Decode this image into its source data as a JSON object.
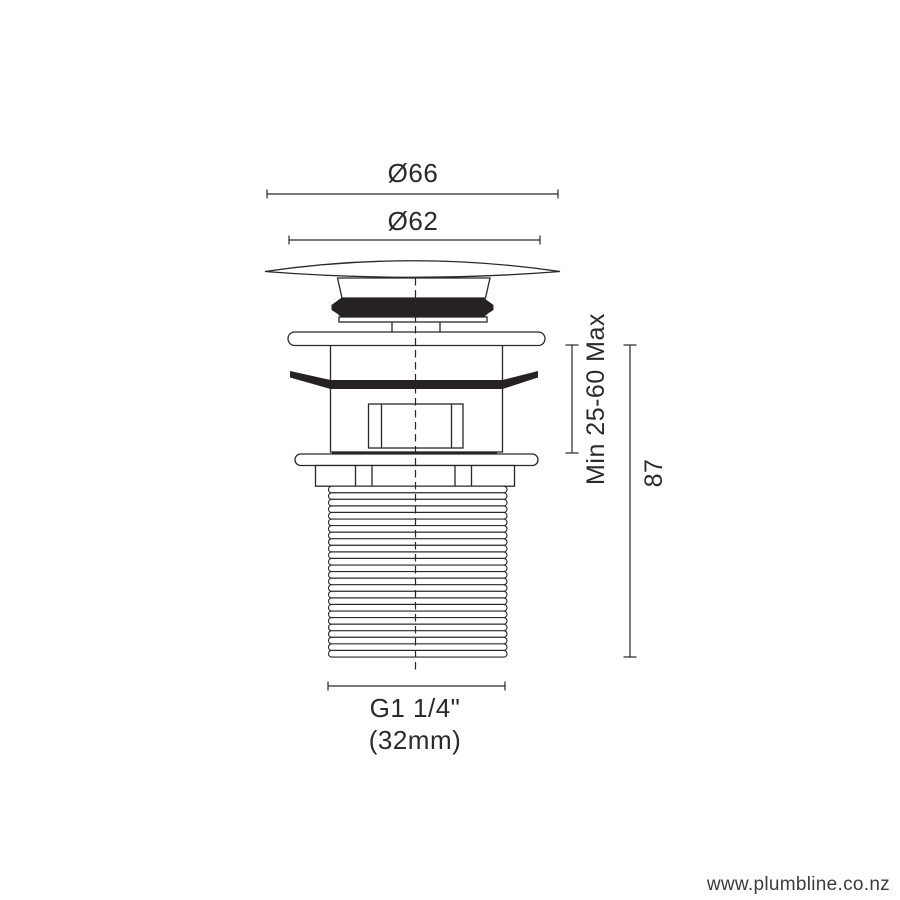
{
  "drawing": {
    "product": "pop-up basin waste dimension drawing",
    "labels": {
      "dia_outer": "Ø66",
      "dia_inner": "Ø62",
      "clamp_range": "Min 25-60 Max",
      "overall_height": "87",
      "thread_size": "G1 1/4\"",
      "thread_size_mm": "(32mm)"
    },
    "watermark": "www.plumbline.co.nz",
    "colors": {
      "line": "#2b2627",
      "fill_black": "#262122",
      "background": "#ffffff",
      "watermark_text": "#3c3c3c"
    }
  }
}
